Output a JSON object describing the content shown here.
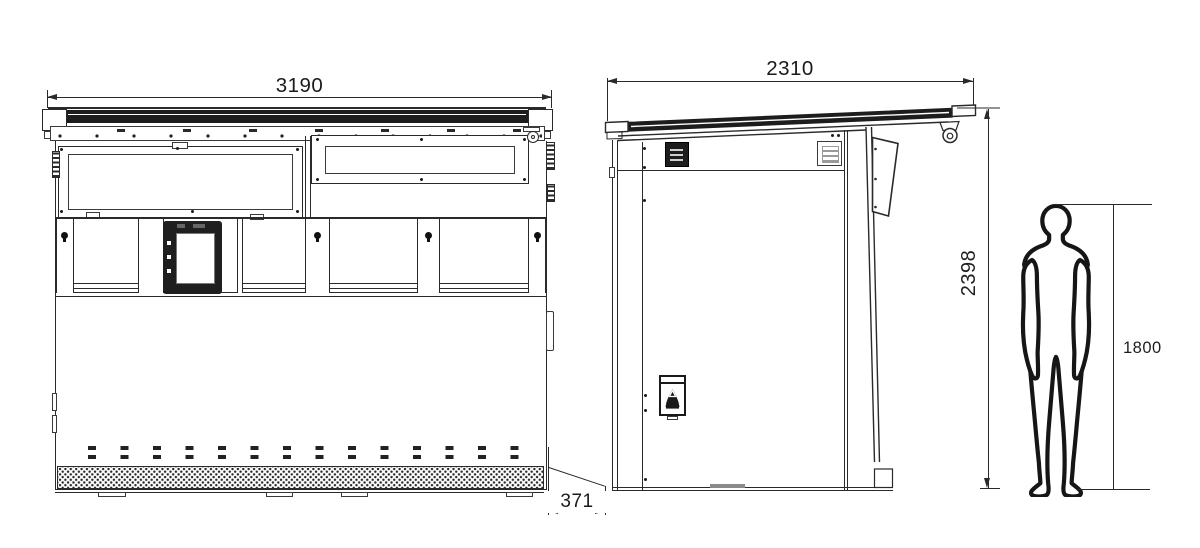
{
  "drawing": {
    "type": "technical-dimension-drawing",
    "dimensions": {
      "front_width": "3190",
      "side_depth": "2310",
      "overall_height": "2398",
      "person_height": "1800",
      "base_offset": "371"
    },
    "colors": {
      "background": "#ffffff",
      "line": "#2a2a2a",
      "dark_fill": "#1d1d1d",
      "mid_gray": "#8a8a8a"
    },
    "icons": [
      "dome-camera-icon",
      "alarm-bell-icon",
      "keyhole-icon",
      "vent-grille",
      "human-figure"
    ]
  }
}
